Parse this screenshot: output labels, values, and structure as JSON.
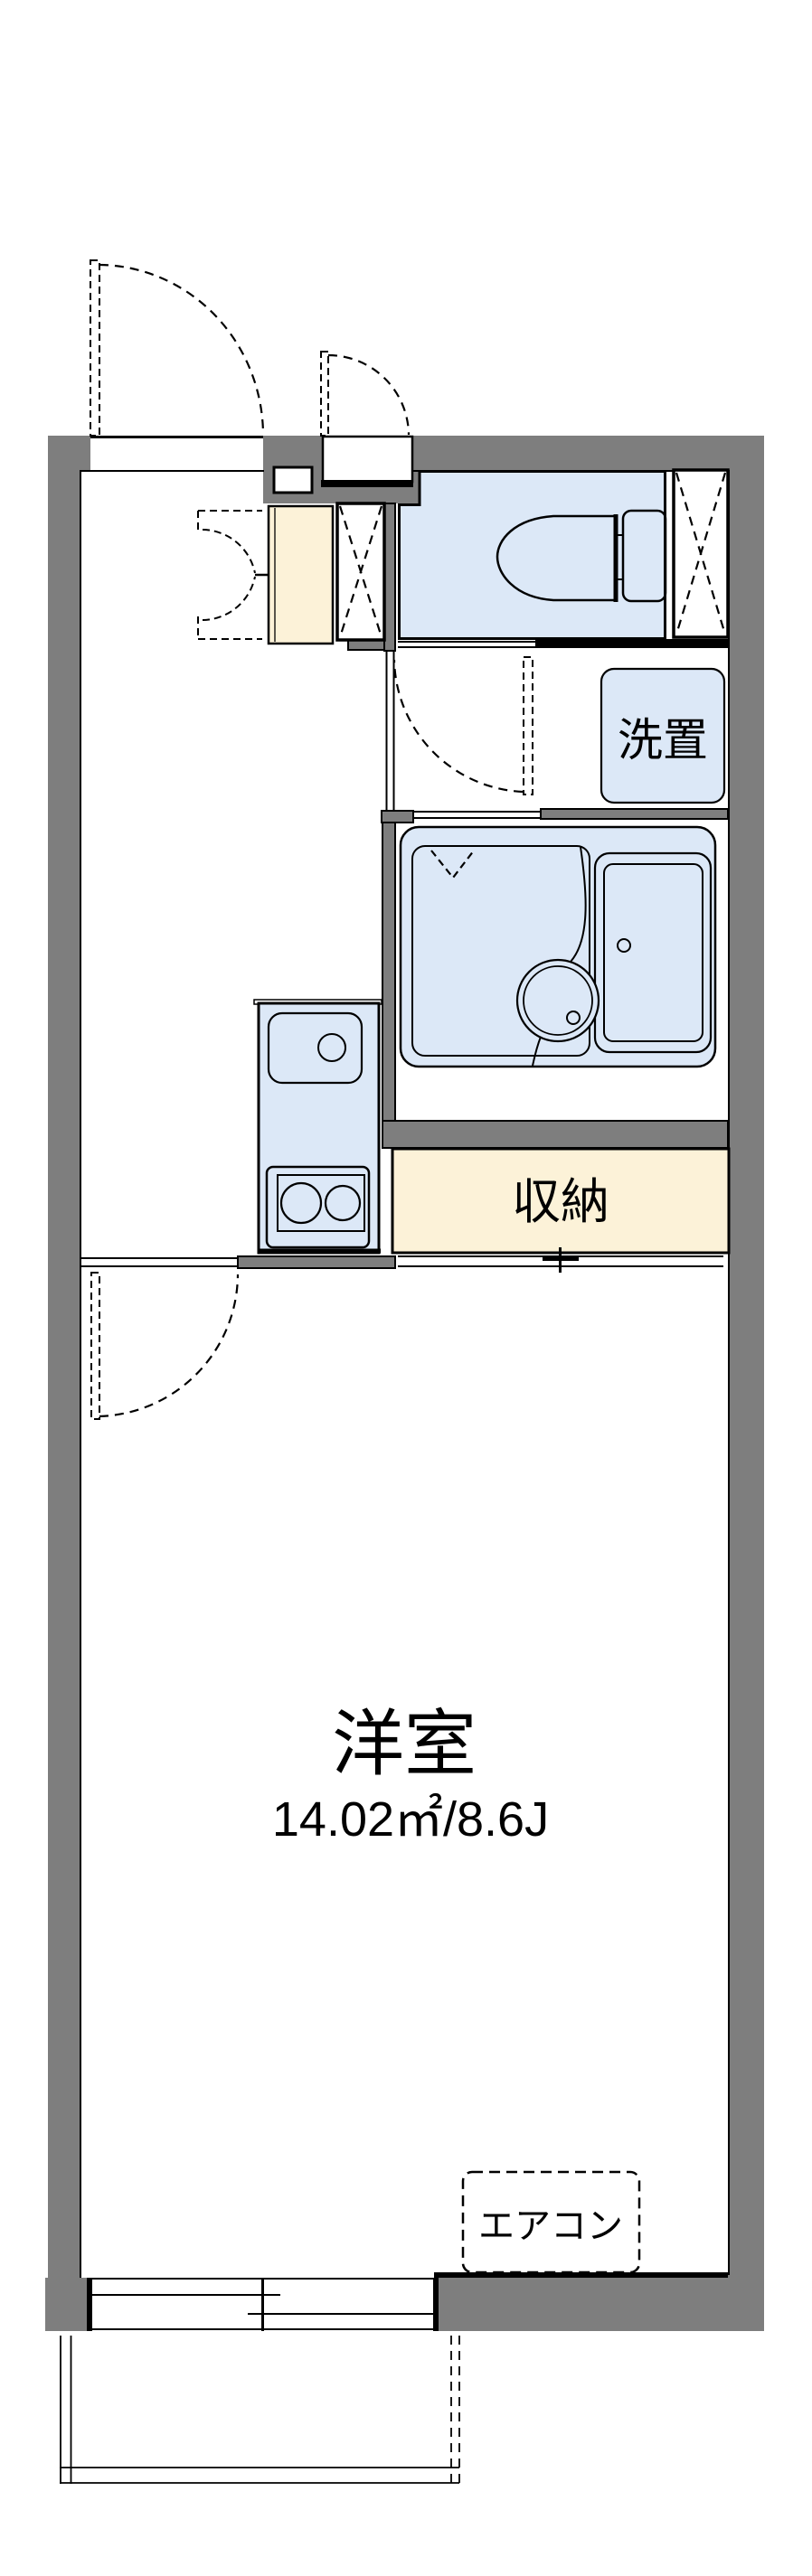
{
  "floor_plan": {
    "type": "apartment-floor-plan",
    "labels": {
      "washer_space": "洗置",
      "storage": "収納",
      "main_room_name": "洋室",
      "main_room_size": "14.02㎡/8.6J",
      "aircon": "エアコン"
    },
    "rooms": [
      {
        "id": "western-room",
        "label": "洋室",
        "size": "14.02㎡/8.6J"
      },
      {
        "id": "storage-closet",
        "label": "収納"
      },
      {
        "id": "washer-space",
        "label": "洗置"
      },
      {
        "id": "air-conditioner",
        "label": "エアコン"
      }
    ],
    "colors": {
      "wall": "#7e7e7e",
      "fixture_fill": "#dce8f7",
      "storage_fill": "#fcf2d8",
      "line": "#000000",
      "background": "#ffffff"
    }
  }
}
